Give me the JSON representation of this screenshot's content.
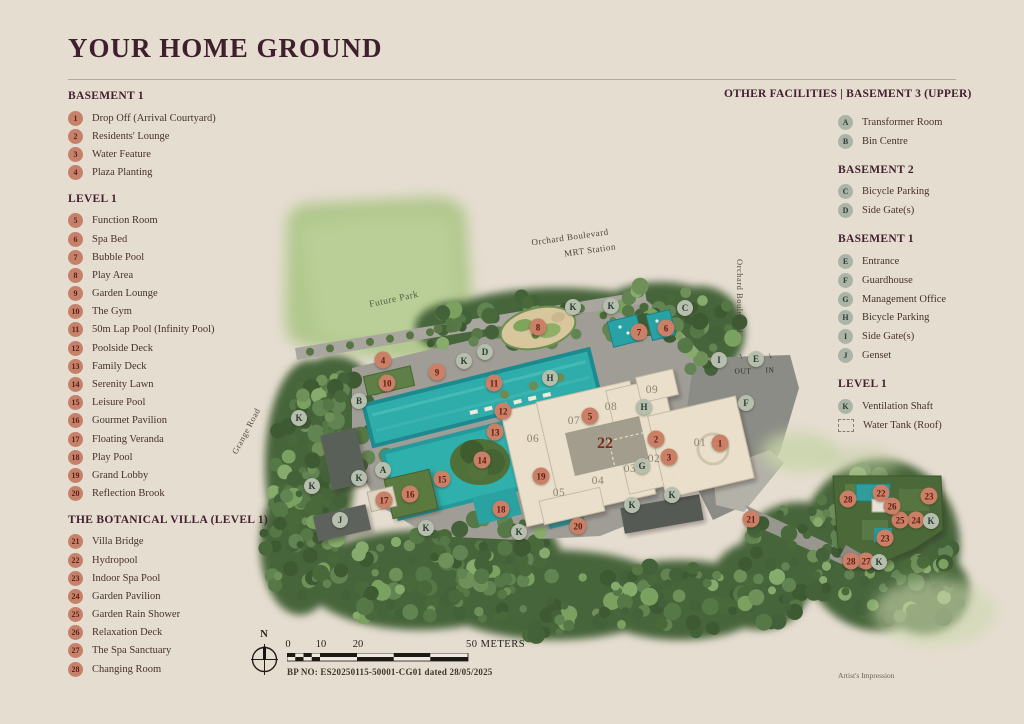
{
  "page": {
    "title": "YOUR HOME GROUND",
    "artists_impression": "Artist's Impression"
  },
  "legend_left": {
    "sections": [
      {
        "heading": "BASEMENT 1",
        "items": [
          {
            "badge": "1",
            "label": "Drop Off (Arrival Courtyard)"
          },
          {
            "badge": "2",
            "label": "Residents' Lounge"
          },
          {
            "badge": "3",
            "label": "Water Feature"
          },
          {
            "badge": "4",
            "label": "Plaza Planting"
          }
        ]
      },
      {
        "heading": "LEVEL 1",
        "items": [
          {
            "badge": "5",
            "label": "Function Room"
          },
          {
            "badge": "6",
            "label": "Spa Bed"
          },
          {
            "badge": "7",
            "label": "Bubble Pool"
          },
          {
            "badge": "8",
            "label": "Play Area"
          },
          {
            "badge": "9",
            "label": "Garden Lounge"
          },
          {
            "badge": "10",
            "label": "The Gym"
          },
          {
            "badge": "11",
            "label": "50m Lap Pool (Infinity Pool)"
          },
          {
            "badge": "12",
            "label": "Poolside Deck"
          },
          {
            "badge": "13",
            "label": "Family Deck"
          },
          {
            "badge": "14",
            "label": "Serenity Lawn"
          },
          {
            "badge": "15",
            "label": "Leisure Pool"
          },
          {
            "badge": "16",
            "label": "Gourmet Pavilion"
          },
          {
            "badge": "17",
            "label": "Floating Veranda"
          },
          {
            "badge": "18",
            "label": "Play Pool"
          },
          {
            "badge": "19",
            "label": "Grand Lobby"
          },
          {
            "badge": "20",
            "label": "Reflection Brook"
          }
        ]
      },
      {
        "heading": "THE BOTANICAL VILLA (LEVEL 1)",
        "items": [
          {
            "badge": "21",
            "label": "Villa Bridge"
          },
          {
            "badge": "22",
            "label": "Hydropool"
          },
          {
            "badge": "23",
            "label": "Indoor Spa Pool"
          },
          {
            "badge": "24",
            "label": "Garden Pavilion"
          },
          {
            "badge": "25",
            "label": "Garden Rain Shower"
          },
          {
            "badge": "26",
            "label": "Relaxation Deck"
          },
          {
            "badge": "27",
            "label": "The Spa Sanctuary"
          },
          {
            "badge": "28",
            "label": "Changing Room"
          }
        ]
      }
    ]
  },
  "legend_right": {
    "heading": "OTHER FACILITIES  |  BASEMENT 3 (UPPER)",
    "sections": [
      {
        "heading": "",
        "items": [
          {
            "badge": "A",
            "label": "Transformer Room"
          },
          {
            "badge": "B",
            "label": "Bin Centre"
          }
        ]
      },
      {
        "heading": "BASEMENT 2",
        "items": [
          {
            "badge": "C",
            "label": "Bicycle Parking"
          },
          {
            "badge": "D",
            "label": "Side Gate(s)"
          }
        ]
      },
      {
        "heading": "BASEMENT 1",
        "items": [
          {
            "badge": "E",
            "label": "Entrance"
          },
          {
            "badge": "F",
            "label": "Guardhouse"
          },
          {
            "badge": "G",
            "label": "Management Office"
          },
          {
            "badge": "H",
            "label": "Bicycle Parking"
          },
          {
            "badge": "I",
            "label": "Side Gate(s)"
          },
          {
            "badge": "J",
            "label": "Genset"
          }
        ]
      },
      {
        "heading": "LEVEL 1",
        "items": [
          {
            "badge": "K",
            "label": "Ventilation Shaft"
          },
          {
            "badge": "",
            "icon": "water-tank",
            "label": "Water Tank (Roof)"
          }
        ]
      }
    ]
  },
  "map": {
    "colors": {
      "background": "#e6ddd1",
      "trees": "#47653a",
      "future_park": "#b1c88d",
      "pool": "#2fadab",
      "deck": "#9f9d96",
      "building": "#e9dfca",
      "villa_roof": "#4b6937",
      "marker_number": "#c98066",
      "marker_letter": "#b6bfae"
    },
    "road_labels": [
      {
        "name": "mrt-station-label-line1",
        "text": "Orchard Boulevard",
        "x": 570,
        "y": 237,
        "rot": -8,
        "size": 9,
        "color": "#4e443a"
      },
      {
        "name": "mrt-station-label-line2",
        "text": "MRT Station",
        "x": 590,
        "y": 250,
        "rot": -8,
        "size": 9,
        "color": "#4e443a"
      },
      {
        "name": "future-park-label",
        "text": "Future Park",
        "x": 394,
        "y": 300,
        "rot": -12,
        "size": 9.5,
        "color": "#535c47"
      },
      {
        "name": "grange-road-label",
        "text": "Grange Road",
        "x": 246,
        "y": 431,
        "rot": -62,
        "size": 8.5,
        "color": "#56493d"
      },
      {
        "name": "orchard-boulevard-label",
        "text": "Orchard Boulevard",
        "x": 740,
        "y": 296,
        "rot": 90,
        "size": 8.5,
        "color": "#56493d"
      },
      {
        "name": "out-label",
        "text": "OUT",
        "x": 743,
        "y": 371,
        "rot": 0,
        "size": 7.5,
        "color": "#2f2b25"
      },
      {
        "name": "in-label",
        "text": "IN",
        "x": 770,
        "y": 370,
        "rot": 0,
        "size": 7.5,
        "color": "#2f2b25"
      },
      {
        "name": "out-arrow-icon",
        "text": "↑",
        "x": 741,
        "y": 356,
        "rot": -25,
        "size": 9,
        "color": "#2f2b25"
      },
      {
        "name": "in-arrow-icon",
        "text": "↓",
        "x": 770,
        "y": 355,
        "rot": -25,
        "size": 9,
        "color": "#2f2b25"
      }
    ],
    "unit_labels": [
      {
        "text": "01",
        "x": 700,
        "y": 443
      },
      {
        "text": "02",
        "x": 654,
        "y": 459
      },
      {
        "text": "03",
        "x": 630,
        "y": 469
      },
      {
        "text": "04",
        "x": 598,
        "y": 481
      },
      {
        "text": "05",
        "x": 559,
        "y": 493
      },
      {
        "text": "06",
        "x": 533,
        "y": 439
      },
      {
        "text": "07",
        "x": 574,
        "y": 421
      },
      {
        "text": "08",
        "x": 611,
        "y": 407
      },
      {
        "text": "09",
        "x": 652,
        "y": 390
      },
      {
        "text": "22",
        "x": 605,
        "y": 444,
        "big": true
      }
    ],
    "markers": [
      {
        "id": "1",
        "t": "n",
        "x": 720,
        "y": 443
      },
      {
        "id": "2",
        "t": "n",
        "x": 656,
        "y": 439
      },
      {
        "id": "3",
        "t": "n",
        "x": 669,
        "y": 457
      },
      {
        "id": "4",
        "t": "n",
        "x": 383,
        "y": 360
      },
      {
        "id": "5",
        "t": "n",
        "x": 590,
        "y": 416
      },
      {
        "id": "6",
        "t": "n",
        "x": 666,
        "y": 328
      },
      {
        "id": "7",
        "t": "n",
        "x": 639,
        "y": 332
      },
      {
        "id": "8",
        "t": "n",
        "x": 538,
        "y": 327
      },
      {
        "id": "9",
        "t": "n",
        "x": 437,
        "y": 372
      },
      {
        "id": "10",
        "t": "n",
        "x": 387,
        "y": 383
      },
      {
        "id": "11",
        "t": "n",
        "x": 494,
        "y": 383
      },
      {
        "id": "12",
        "t": "n",
        "x": 503,
        "y": 411
      },
      {
        "id": "13",
        "t": "n",
        "x": 495,
        "y": 432
      },
      {
        "id": "14",
        "t": "n",
        "x": 482,
        "y": 460
      },
      {
        "id": "15",
        "t": "n",
        "x": 442,
        "y": 479
      },
      {
        "id": "16",
        "t": "n",
        "x": 410,
        "y": 494
      },
      {
        "id": "17",
        "t": "n",
        "x": 384,
        "y": 500
      },
      {
        "id": "18",
        "t": "n",
        "x": 501,
        "y": 509
      },
      {
        "id": "19",
        "t": "n",
        "x": 541,
        "y": 476
      },
      {
        "id": "20",
        "t": "n",
        "x": 578,
        "y": 526
      },
      {
        "id": "21",
        "t": "n",
        "x": 751,
        "y": 519
      },
      {
        "id": "22",
        "t": "n",
        "x": 881,
        "y": 493
      },
      {
        "id": "23",
        "t": "n",
        "x": 929,
        "y": 496
      },
      {
        "id": "23",
        "t": "n",
        "x": 885,
        "y": 538
      },
      {
        "id": "24",
        "t": "n",
        "x": 916,
        "y": 520
      },
      {
        "id": "25",
        "t": "n",
        "x": 900,
        "y": 520
      },
      {
        "id": "26",
        "t": "n",
        "x": 892,
        "y": 506
      },
      {
        "id": "27",
        "t": "n",
        "x": 866,
        "y": 561
      },
      {
        "id": "28",
        "t": "n",
        "x": 848,
        "y": 499
      },
      {
        "id": "28",
        "t": "n",
        "x": 851,
        "y": 561
      },
      {
        "id": "A",
        "t": "l",
        "x": 383,
        "y": 470
      },
      {
        "id": "B",
        "t": "l",
        "x": 359,
        "y": 401
      },
      {
        "id": "C",
        "t": "l",
        "x": 685,
        "y": 308
      },
      {
        "id": "D",
        "t": "l",
        "x": 485,
        "y": 352
      },
      {
        "id": "E",
        "t": "l",
        "x": 756,
        "y": 359
      },
      {
        "id": "F",
        "t": "l",
        "x": 746,
        "y": 403
      },
      {
        "id": "G",
        "t": "l",
        "x": 642,
        "y": 466
      },
      {
        "id": "H",
        "t": "l",
        "x": 550,
        "y": 378
      },
      {
        "id": "H",
        "t": "l",
        "x": 644,
        "y": 407
      },
      {
        "id": "I",
        "t": "l",
        "x": 719,
        "y": 360
      },
      {
        "id": "J",
        "t": "l",
        "x": 340,
        "y": 520
      },
      {
        "id": "K",
        "t": "l",
        "x": 464,
        "y": 361
      },
      {
        "id": "K",
        "t": "l",
        "x": 573,
        "y": 307
      },
      {
        "id": "K",
        "t": "l",
        "x": 611,
        "y": 306
      },
      {
        "id": "K",
        "t": "l",
        "x": 299,
        "y": 418
      },
      {
        "id": "K",
        "t": "l",
        "x": 359,
        "y": 478
      },
      {
        "id": "K",
        "t": "l",
        "x": 312,
        "y": 486
      },
      {
        "id": "K",
        "t": "l",
        "x": 426,
        "y": 528
      },
      {
        "id": "K",
        "t": "l",
        "x": 519,
        "y": 532
      },
      {
        "id": "K",
        "t": "l",
        "x": 632,
        "y": 505
      },
      {
        "id": "K",
        "t": "l",
        "x": 672,
        "y": 495
      },
      {
        "id": "K",
        "t": "l",
        "x": 931,
        "y": 521
      },
      {
        "id": "K",
        "t": "l",
        "x": 879,
        "y": 562
      }
    ]
  },
  "scale_bar": {
    "north_label": "N",
    "ticks": [
      "0",
      "10",
      "20"
    ],
    "end_label": "50 METERS",
    "bp_no": "BP NO: ES20250115-50001-CG01 dated 28/05/2025"
  }
}
